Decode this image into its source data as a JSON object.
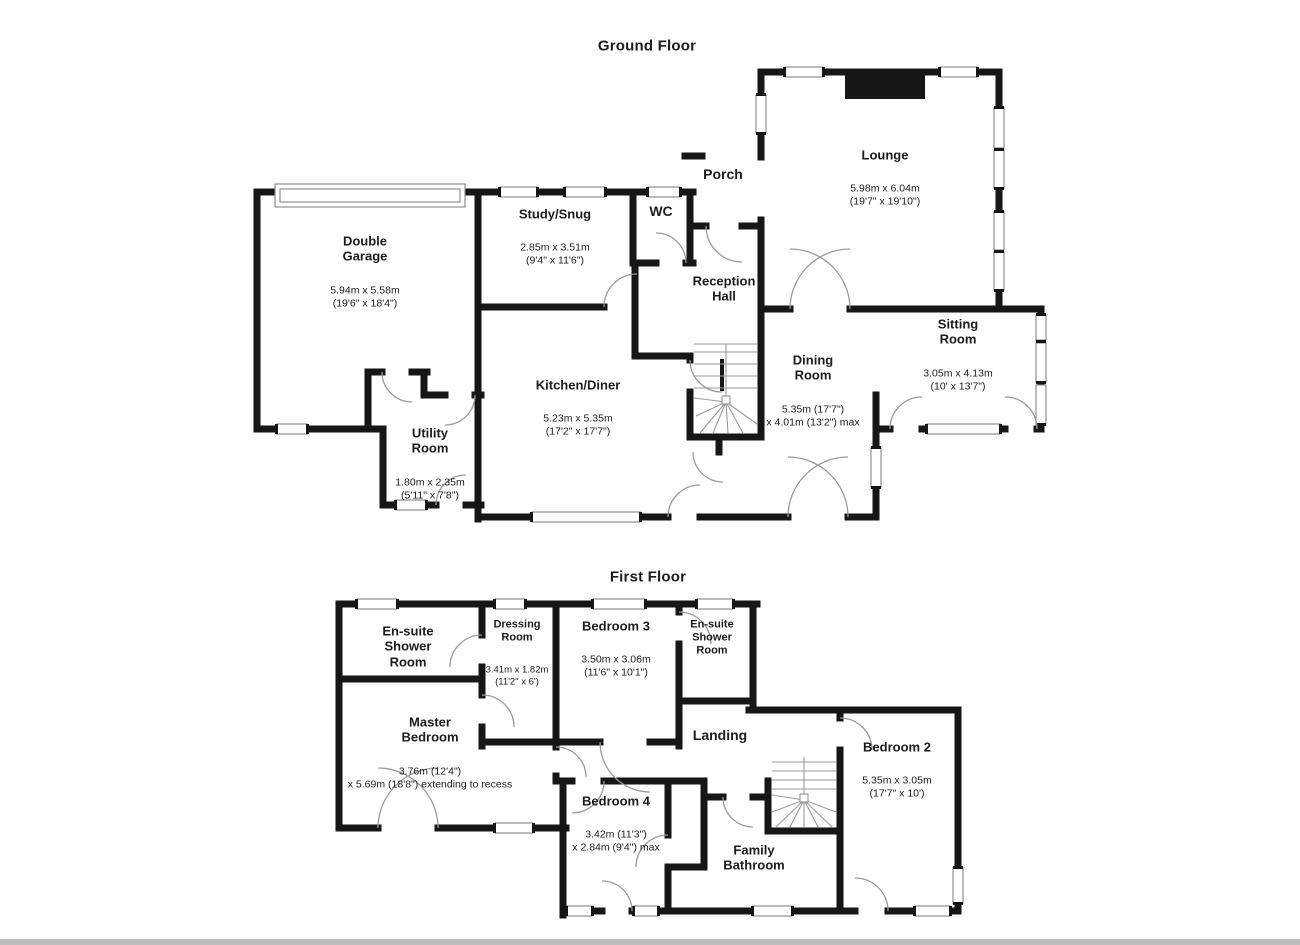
{
  "document_type": "Floorplan",
  "colors": {
    "wall": "#161616",
    "door_arc": "#9a9a9a",
    "window_outline": "#858585",
    "scan_edge": "#bdbdbd",
    "background": "#ffffff"
  },
  "floors": [
    {
      "title": "Ground Floor",
      "rooms": [
        {
          "name": "Lounge",
          "dims": "5.98m x 6.04m\n(19'7\" x 19'10\")"
        },
        {
          "name": "Porch",
          "dims": ""
        },
        {
          "name": "Study/Snug",
          "dims": "2.85m x 3.51m\n(9'4\" x 11'6\")"
        },
        {
          "name": "WC",
          "dims": ""
        },
        {
          "name": "Reception\nHall",
          "dims": ""
        },
        {
          "name": "Double\nGarage",
          "dims": "5.94m x 5.58m\n(19'6\" x 18'4\")"
        },
        {
          "name": "Kitchen/Diner",
          "dims": "5.23m x 5.35m\n(17'2\" x 17'7\")"
        },
        {
          "name": "Utility\nRoom",
          "dims": "1.80m x 2.35m\n(5'11\" x 7'8\")"
        },
        {
          "name": "Dining\nRoom",
          "dims": "5.35m (17'7\")\nx 4.01m (13'2\") max"
        },
        {
          "name": "Sitting\nRoom",
          "dims": "3.05m x 4.13m\n(10' x 13'7\")"
        }
      ]
    },
    {
      "title": "First Floor",
      "rooms": [
        {
          "name": "En-suite\nShower\nRoom",
          "dims": ""
        },
        {
          "name": "Dressing\nRoom",
          "dims": "3.41m x 1.82m\n(11'2\" x 6')"
        },
        {
          "name": "Bedroom 3",
          "dims": "3.50m x 3.06m\n(11'6\" x 10'1\")"
        },
        {
          "name": "En-suite\nShower\nRoom",
          "dims": ""
        },
        {
          "name": "Landing",
          "dims": ""
        },
        {
          "name": "Master\nBedroom",
          "dims": "3.76m (12'4\")\nx 5.69m (18'8\") extending to recess"
        },
        {
          "name": "Bedroom 2",
          "dims": "5.35m x 3.05m\n(17'7\" x 10')"
        },
        {
          "name": "Bedroom 4",
          "dims": "3.42m (11'3\")\nx 2.84m (9'4\") max"
        },
        {
          "name": "Family\nBathroom",
          "dims": ""
        }
      ]
    }
  ]
}
